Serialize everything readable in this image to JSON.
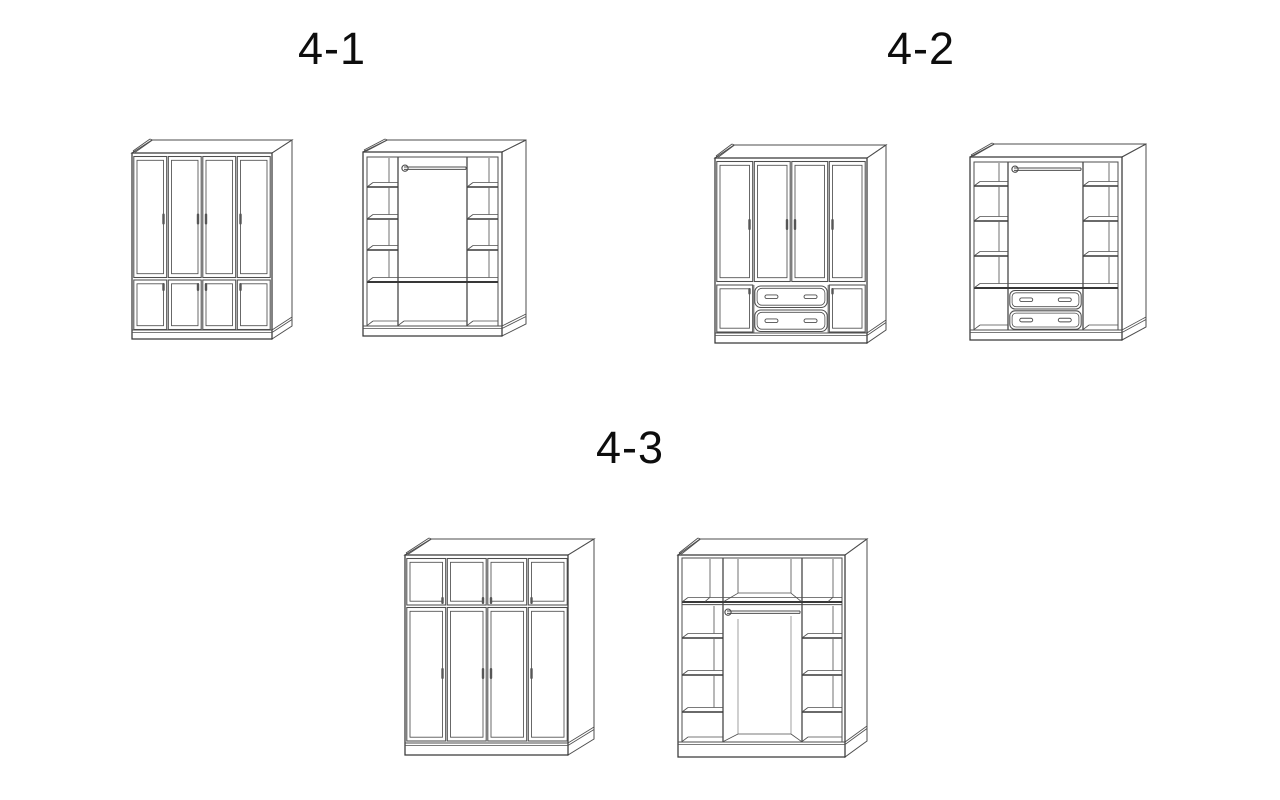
{
  "page": {
    "width": 1280,
    "height": 800,
    "background": "#ffffff",
    "description": "Wardrobe configuration diagram with three numbered variants, each shown as a closed exterior view and an open interior view"
  },
  "style": {
    "line": "#4e4e4e",
    "line_strong": "#383838",
    "line_light": "#777777",
    "handle_fill": "#565656",
    "label_color": "#0d0d0d"
  },
  "groups": [
    {
      "label": "4-1",
      "label_cx": 332,
      "label_top": 26,
      "figures": [
        {
          "name": "wardrobe-4-1-closed",
          "template": "ext_tall_small",
          "view": "closed exterior: four tall paneled doors over four small paneled doors",
          "x": 128,
          "y": 136,
          "w": 166,
          "h": 208
        },
        {
          "name": "wardrobe-4-1-interior",
          "template": "int_open",
          "view": "open interior: left and right shelf columns, center hanging rod, full shelf, three open bottom compartments",
          "x": 360,
          "y": 136,
          "w": 182,
          "h": 210
        }
      ]
    },
    {
      "label": "4-2",
      "label_cx": 921,
      "label_top": 26,
      "figures": [
        {
          "name": "wardrobe-4-2-closed",
          "template": "ext_tall_drawers",
          "view": "closed exterior: four tall paneled doors, bottom row of small door + two stacked drawers + small door",
          "x": 708,
          "y": 138,
          "w": 178,
          "h": 209
        },
        {
          "name": "wardrobe-4-2-interior",
          "template": "int_drawers",
          "view": "open interior: shelf columns, center hanging rod, two stacked center drawers, open bottom side cells",
          "x": 963,
          "y": 138,
          "w": 187,
          "h": 212
        }
      ]
    },
    {
      "label": "4-3",
      "label_cx": 630,
      "label_top": 425,
      "figures": [
        {
          "name": "wardrobe-4-3-closed",
          "template": "ext_small_tall",
          "view": "closed exterior: four small paneled doors on top over four tall paneled doors",
          "x": 402,
          "y": 526,
          "w": 200,
          "h": 235
        },
        {
          "name": "wardrobe-4-3-interior",
          "template": "int_topband",
          "view": "open interior: top cubby row over full shelf, center hanging rod, left and right shelf columns, open center",
          "x": 670,
          "y": 526,
          "w": 200,
          "h": 235
        }
      ]
    }
  ]
}
